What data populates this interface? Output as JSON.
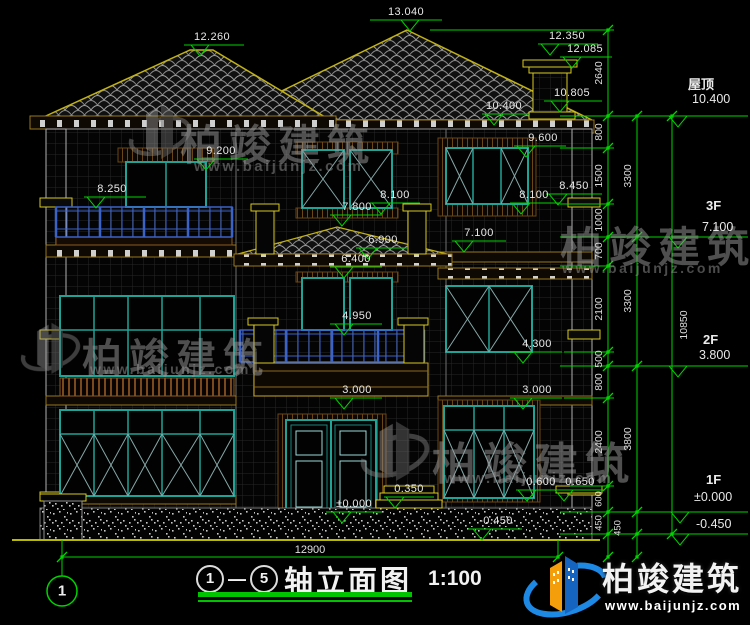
{
  "drawing": {
    "width_dim": "12900",
    "title": {
      "axis_from": "1",
      "separator": "—",
      "axis_to": "5",
      "name": "轴立面图",
      "scale": "1:100",
      "axis_bubble": "1"
    }
  },
  "facade_markers": [
    "13.040",
    "12.260",
    "12.350",
    "12.085",
    "10.805",
    "10.400",
    "9.200",
    "9.600",
    "8.250",
    "8.450",
    "8.100",
    "8.100",
    "7.800",
    "7.100",
    "6.900",
    "6.400",
    "4.950",
    "4.300",
    "3.000",
    "3.000",
    "0.350",
    "±0.000",
    "0.600",
    "0.650",
    "-0.450"
  ],
  "right_legend": {
    "roof_label": "屋顶",
    "roof_value": "10.400",
    "f3_label": "3F",
    "f3_value": "7.100",
    "f2_label": "2F",
    "f2_value": "3.800",
    "f1_label": "1F",
    "f1_value": "±0.000",
    "ground_value": "-0.450"
  },
  "dim_chains": {
    "inner": [
      "2640",
      "800",
      "1500",
      "1000",
      "700",
      "2100",
      "500",
      "800",
      "2400",
      "600",
      "450"
    ],
    "mid": [
      "3300",
      "3300",
      "3800",
      "450"
    ],
    "overall": "10850"
  },
  "watermark": {
    "brand": "柏竣建筑",
    "url": "www.baijunjz.com"
  },
  "logo": {
    "brand": "柏竣建筑",
    "url": "www.baijunjz.com"
  }
}
